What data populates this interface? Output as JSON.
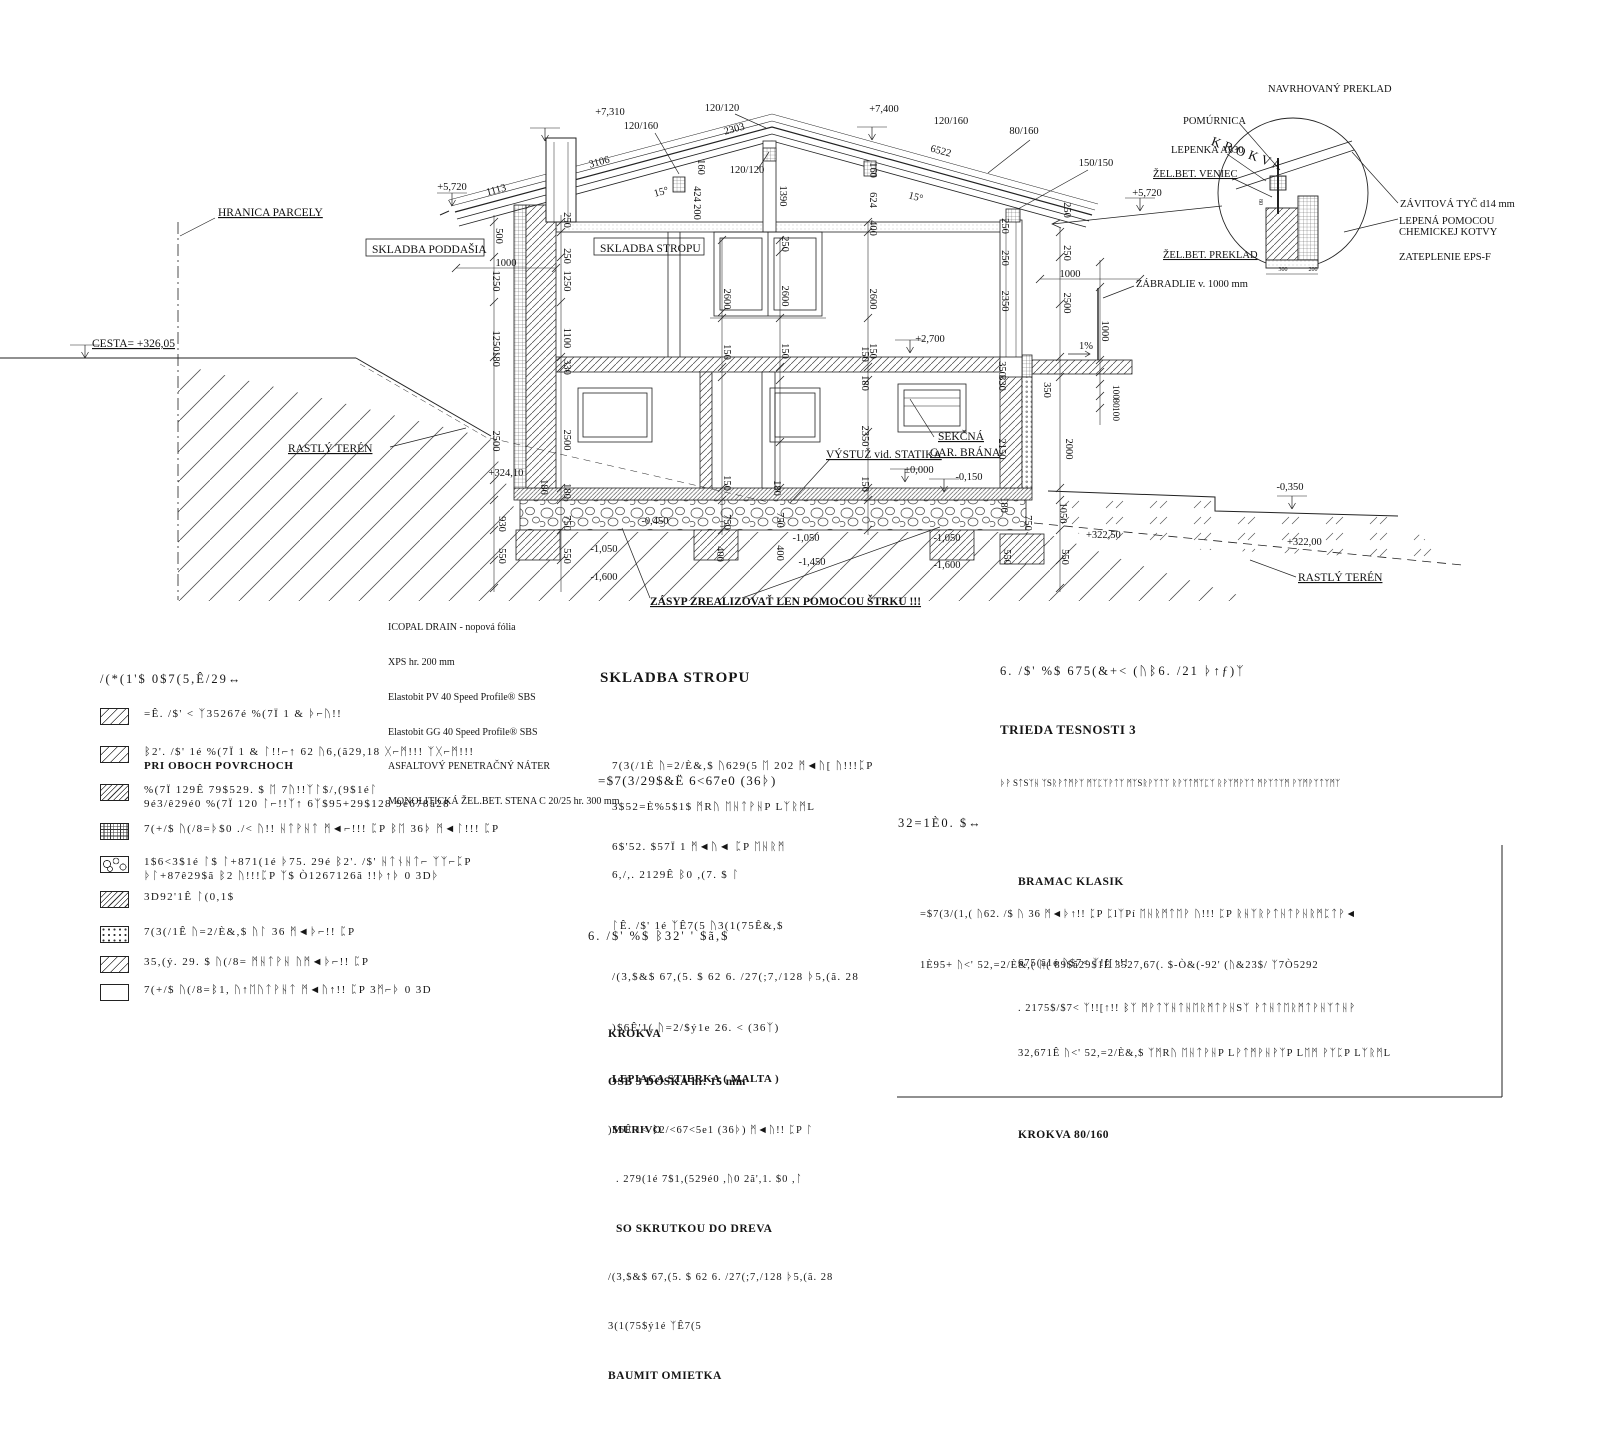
{
  "drawing": {
    "labels": [
      {
        "t": "+7,310",
        "x": 610,
        "y": 115
      },
      {
        "t": "120/160",
        "x": 641,
        "y": 129
      },
      {
        "t": "120/120",
        "x": 722,
        "y": 111
      },
      {
        "t": "2303",
        "x": 735,
        "y": 132,
        "r": -15
      },
      {
        "t": "+7,400",
        "x": 884,
        "y": 112
      },
      {
        "t": "120/160",
        "x": 951,
        "y": 124
      },
      {
        "t": "6522",
        "x": 940,
        "y": 154,
        "r": 15
      },
      {
        "t": "80/160",
        "x": 1024,
        "y": 134
      },
      {
        "t": "150/150",
        "x": 1096,
        "y": 166
      },
      {
        "t": "+5,720",
        "x": 1147,
        "y": 196
      },
      {
        "t": "+5,720",
        "x": 452,
        "y": 190
      },
      {
        "t": "3106",
        "x": 600,
        "y": 165,
        "r": -15
      },
      {
        "t": "1113",
        "x": 497,
        "y": 193,
        "r": -15
      },
      {
        "t": "120/120",
        "x": 747,
        "y": 173
      },
      {
        "t": "1390",
        "x": 780,
        "y": 196,
        "r": 90
      },
      {
        "t": "424",
        "x": 694,
        "y": 194,
        "r": 90
      },
      {
        "t": "200",
        "x": 694,
        "y": 212,
        "r": 90
      },
      {
        "t": "160",
        "x": 698,
        "y": 167,
        "r": 90
      },
      {
        "t": "15°",
        "x": 662,
        "y": 195,
        "r": -15
      },
      {
        "t": "15°",
        "x": 915,
        "y": 200,
        "r": 15
      },
      {
        "t": "160",
        "x": 870,
        "y": 170,
        "r": 90
      },
      {
        "t": "624",
        "x": 870,
        "y": 200,
        "r": 90
      },
      {
        "t": "400",
        "x": 870,
        "y": 228,
        "r": 90
      },
      {
        "t": "250",
        "x": 1002,
        "y": 226,
        "r": 90
      },
      {
        "t": "250",
        "x": 1002,
        "y": 258,
        "r": 90
      },
      {
        "t": "250",
        "x": 1064,
        "y": 210,
        "r": 90
      },
      {
        "t": "250",
        "x": 1064,
        "y": 253,
        "r": 90
      },
      {
        "t": "1000",
        "x": 1070,
        "y": 277
      },
      {
        "t": "500",
        "x": 496,
        "y": 236,
        "r": 90
      },
      {
        "t": "1000",
        "x": 506,
        "y": 266
      },
      {
        "t": "1250",
        "x": 493,
        "y": 281,
        "r": 90
      },
      {
        "t": "1250",
        "x": 493,
        "y": 341,
        "r": 90
      },
      {
        "t": "180",
        "x": 493,
        "y": 359,
        "r": 90
      },
      {
        "t": "2500",
        "x": 493,
        "y": 441,
        "r": 90
      },
      {
        "t": "+324,10",
        "x": 506,
        "y": 476
      },
      {
        "t": "250",
        "x": 564,
        "y": 220,
        "r": 90
      },
      {
        "t": "250",
        "x": 564,
        "y": 256,
        "r": 90
      },
      {
        "t": "1250",
        "x": 564,
        "y": 281,
        "r": 90
      },
      {
        "t": "1100",
        "x": 564,
        "y": 338,
        "r": 90
      },
      {
        "t": "330",
        "x": 564,
        "y": 367,
        "r": 90
      },
      {
        "t": "2500",
        "x": 564,
        "y": 440,
        "r": 90
      },
      {
        "t": "180",
        "x": 564,
        "y": 491,
        "r": 90
      },
      {
        "t": "2600",
        "x": 724,
        "y": 299,
        "r": 90
      },
      {
        "t": "2600",
        "x": 782,
        "y": 296,
        "r": 90
      },
      {
        "t": "2600",
        "x": 870,
        "y": 299,
        "r": 90
      },
      {
        "t": "150",
        "x": 724,
        "y": 352,
        "r": 90
      },
      {
        "t": "150",
        "x": 782,
        "y": 351,
        "r": 90
      },
      {
        "t": "150",
        "x": 870,
        "y": 351,
        "r": 90
      },
      {
        "t": "250",
        "x": 782,
        "y": 244,
        "r": 90
      },
      {
        "t": "+2,700",
        "x": 930,
        "y": 342
      },
      {
        "t": "2350",
        "x": 1002,
        "y": 301,
        "r": 90
      },
      {
        "t": "1%",
        "x": 1086,
        "y": 349
      },
      {
        "t": "150",
        "x": 862,
        "y": 354,
        "r": 90
      },
      {
        "t": "180",
        "x": 862,
        "y": 383,
        "r": 90
      },
      {
        "t": "2350",
        "x": 862,
        "y": 436,
        "r": 90
      },
      {
        "t": "150",
        "x": 862,
        "y": 484,
        "r": 90
      },
      {
        "t": "350",
        "x": 999,
        "y": 369,
        "r": 90
      },
      {
        "t": "330",
        "x": 999,
        "y": 383,
        "r": 90
      },
      {
        "t": "2150",
        "x": 999,
        "y": 449,
        "r": 90
      },
      {
        "t": "2000",
        "x": 1066,
        "y": 449,
        "r": 90
      },
      {
        "t": "350",
        "x": 1044,
        "y": 390,
        "r": 90
      },
      {
        "t": "1000",
        "x": 1102,
        "y": 331,
        "r": 90
      },
      {
        "t": "100",
        "x": 1113,
        "y": 392,
        "r": 90,
        "s": 9.5
      },
      {
        "t": "80",
        "x": 1113,
        "y": 403,
        "r": 90,
        "s": 9.5
      },
      {
        "t": "100",
        "x": 1113,
        "y": 414,
        "r": 90,
        "s": 9.5
      },
      {
        "t": "2500",
        "x": 1064,
        "y": 303,
        "r": 90
      },
      {
        "t": "180",
        "x": 541,
        "y": 487,
        "r": 90
      },
      {
        "t": "930",
        "x": 499,
        "y": 524,
        "r": 90
      },
      {
        "t": "550",
        "x": 499,
        "y": 556,
        "r": 90
      },
      {
        "t": "750",
        "x": 564,
        "y": 523,
        "r": 90
      },
      {
        "t": "550",
        "x": 564,
        "y": 556,
        "r": 90
      },
      {
        "t": "-0,450",
        "x": 655,
        "y": 524
      },
      {
        "t": "-1,050",
        "x": 604,
        "y": 552
      },
      {
        "t": "-1,600",
        "x": 604,
        "y": 580
      },
      {
        "t": "150",
        "x": 724,
        "y": 483,
        "r": 90
      },
      {
        "t": "750",
        "x": 724,
        "y": 522,
        "r": 90
      },
      {
        "t": "400",
        "x": 717,
        "y": 554,
        "r": 90
      },
      {
        "t": "180",
        "x": 774,
        "y": 488,
        "r": 90
      },
      {
        "t": "750",
        "x": 777,
        "y": 520,
        "r": 90
      },
      {
        "t": "400",
        "x": 777,
        "y": 553,
        "r": 90
      },
      {
        "t": "-1,050",
        "x": 806,
        "y": 541
      },
      {
        "t": "-1,450",
        "x": 812,
        "y": 565
      },
      {
        "t": "-1,050",
        "x": 947,
        "y": 541
      },
      {
        "t": "-1,600",
        "x": 947,
        "y": 568
      },
      {
        "t": "-0,150",
        "x": 969,
        "y": 480
      },
      {
        "t": "±0,000",
        "x": 919,
        "y": 473
      },
      {
        "t": "550",
        "x": 1004,
        "y": 557,
        "r": 90
      },
      {
        "t": "750",
        "x": 1025,
        "y": 523,
        "r": 90
      },
      {
        "t": "180",
        "x": 1001,
        "y": 505,
        "r": 90
      },
      {
        "t": "1050",
        "x": 1060,
        "y": 513,
        "r": 90
      },
      {
        "t": "550",
        "x": 1062,
        "y": 557,
        "r": 90
      },
      {
        "t": "+322,50",
        "x": 1086,
        "y": 538,
        "a": "s"
      },
      {
        "t": "-0,350",
        "x": 1290,
        "y": 490
      },
      {
        "t": "+322,00",
        "x": 1287,
        "y": 545,
        "a": "s"
      },
      {
        "t": "300",
        "x": 1283,
        "y": 271,
        "s": 6
      },
      {
        "t": "200",
        "x": 1313,
        "y": 271,
        "s": 6
      },
      {
        "t": "80",
        "x": 1259,
        "y": 202,
        "r": 90,
        "s": 6
      },
      {
        "n": "label-hranica-parcely",
        "t": "HRANICA PARCELY",
        "x": 218,
        "y": 216,
        "a": "s",
        "u": 1,
        "s": 11.5
      },
      {
        "n": "label-cesta",
        "t": "CESTA= +326,05",
        "x": 92,
        "y": 347,
        "a": "s",
        "u": 1,
        "s": 11.5
      },
      {
        "n": "label-rastly-teren-left",
        "t": "RASTLÝ TERÉN",
        "x": 288,
        "y": 452,
        "a": "s",
        "u": 1,
        "s": 11.5
      },
      {
        "n": "label-rastly-teren-right",
        "t": "RASTLÝ TERÉN",
        "x": 1298,
        "y": 581,
        "a": "s",
        "u": 1,
        "s": 11.5
      },
      {
        "n": "label-vystuz-statika",
        "t": "VÝSTUŽ vid. STATIKA",
        "x": 826,
        "y": 458,
        "a": "s",
        "u": 1,
        "s": 11.5
      },
      {
        "n": "label-sekcna",
        "t": "SEKČNÁ",
        "x": 938,
        "y": 440,
        "a": "s",
        "u": 1,
        "s": 11.5
      },
      {
        "n": "label-gar-brana",
        "t": "GAR. BRÁNA",
        "x": 930,
        "y": 456,
        "a": "s",
        "u": 1,
        "s": 11.5
      },
      {
        "n": "label-zasyp",
        "t": "ZÁSYP ZREALIZOVAŤ LEN POMOCOU ŠTRKU !!!",
        "x": 650,
        "y": 605,
        "a": "s",
        "u": 1,
        "b": 1,
        "s": 11.5
      },
      {
        "n": "label-skladba-poddasia",
        "t": "SKLADBA PODDAŠIA",
        "x": 372,
        "y": 253,
        "a": "s",
        "s": 11.5
      },
      {
        "n": "label-skladba-stropu-box",
        "t": "SKLADBA STROPU",
        "x": 600,
        "y": 252,
        "a": "s",
        "s": 11.5
      },
      {
        "n": "label-navrhovany-preklad",
        "t": "NAVRHOVANÝ PREKLAD",
        "x": 1268,
        "y": 92,
        "a": "s",
        "s": 10.5
      },
      {
        "n": "label-pomurnica",
        "t": "POMÚRNICA",
        "x": 1183,
        "y": 124,
        "a": "s",
        "s": 10.5
      },
      {
        "n": "label-lepenka-a330",
        "t": "LEPENKA A330",
        "x": 1171,
        "y": 153,
        "a": "s",
        "s": 10.5
      },
      {
        "n": "label-zelbet-veniec",
        "t": "ŽEL.BET. VENIEC",
        "x": 1153,
        "y": 177,
        "a": "s",
        "u": 1,
        "s": 10.5
      },
      {
        "n": "label-krokva",
        "t": "KROKVA",
        "x": 1247,
        "y": 158,
        "r": 20,
        "s": 13,
        "ls": 4
      },
      {
        "n": "label-zelbet-preklad",
        "t": "ŽEL.BET. PREKLAD",
        "x": 1163,
        "y": 258,
        "a": "s",
        "u": 1,
        "s": 10.5
      },
      {
        "n": "label-zavitova-tyc",
        "t": "ZÁVITOVÁ TYČ d14 mm",
        "x": 1400,
        "y": 207,
        "a": "s",
        "s": 10.5
      },
      {
        "n": "label-lepena-pomocou",
        "t": "LEPENÁ POMOCOU",
        "x": 1399,
        "y": 224,
        "a": "s",
        "s": 10.5
      },
      {
        "n": "label-chemickej-kotvy",
        "t": "CHEMICKEJ KOTVY",
        "x": 1399,
        "y": 235,
        "a": "s",
        "s": 10.5
      },
      {
        "n": "label-zateplenie-eps",
        "t": "ZATEPLENIE EPS-F",
        "x": 1399,
        "y": 260,
        "a": "s",
        "s": 10.5
      },
      {
        "n": "label-zabradlie",
        "t": "ZÁBRADLIE v. 1000 mm",
        "x": 1136,
        "y": 287,
        "a": "s",
        "s": 10.5
      }
    ]
  },
  "legend": {
    "title": "/(*(1'$ 0$7(5,Ê/29↔",
    "items": [
      {
        "swatch": "diag",
        "lines": [
          "=Ê. /$' < ᛉ35267é %(7Ï 1 & ᚦ⌐ᚢ!!"
        ]
      },
      {
        "swatch": "diag",
        "lines": [
          "ᛒ2'. /$' 1é %(7Ï 1 & ᛚ!!⌐↑ 62 ᚢ6,(ã29,18 ᚷ⌐ᛗ!!! ᛉᚷ⌐ᛗ!!!",
          "PRI OBOCH POVRCHOCH"
        ]
      },
      {
        "swatch": "diag2",
        "lines": [
          "%(7Ï 129Ê 79$529. $ ᛖ 7ᚢ!!ᛉᛚ$/,(9$1éᛚ",
          "9é3/ê29é0 %(7Ï 120 ᛚ⌐!!ᛉ↑ 6ᛉ$95+29$128 9é678ã28"
        ]
      },
      {
        "swatch": "brick",
        "lines": [
          "7(+/$ ᚢ(/8=ᚦ$0 ./< ᚢ!! ᚺᛏᚹᚺᛏ ᛗ◄⌐!!! ᛈP ᛒᛖ 36ᚦ ᛗ◄ᛚ!!! ᛈP"
        ]
      },
      {
        "swatch": "stone",
        "lines": [
          "1$6<3$1é ᛚ$ ᛚ+871(1é ᚦ75. 29é ᛒ2'. /$' ᚺᛏᚾᚺᛏ⌐ ᛉᛉ⌐ᛈP",
          "ᚦᛚ+87ê29$ã ᛒ2 ᚢ!!!ᛈP ᛉ$ Ò1267126ã !!ᚦ↑ᚦ 0 3Dᚦ"
        ]
      },
      {
        "swatch": "diag2",
        "lines": [
          "3D92'1Ê ᛚ(0,1$"
        ]
      },
      {
        "swatch": "dots",
        "lines": [
          "7(3(/1Ê ᚢ=2/È&,$ ᚢᛚ 36 ᛗ◄ᚦ⌐!! ᛈP"
        ]
      },
      {
        "swatch": "diag",
        "lines": [
          "35,(ý. 29. $ ᚢ(/8= ᛗᚺᛏᚹᚺ ᚢᛗ◄ᚦ⌐!! ᛈP"
        ]
      },
      {
        "swatch": "empty",
        "lines": [
          "7(+/$ ᚢ(/8=ᛒ1, ᚢ↑ᛖᚢᛏᚹᚺᛏ ᛗ◄ᚢ↑!! ᛈP 3ᛗ⌐ᚦ 0 3D"
        ]
      }
    ]
  },
  "icopal": {
    "lines": [
      "ICOPAL DRAIN - nopová fólia",
      "XPS hr. 200 mm",
      "Elastobit PV 40 Speed Profile® SBS",
      "Elastobit GG 40 Speed Profile® SBS",
      "ASFALTOVÝ PENETRAČNÝ NÁTER",
      "MONOLITICKÁ ŽEL.BET. STENA C 20/25 hr. 300 mm"
    ]
  },
  "sections": {
    "stropu": {
      "title": "SKLADBA STROPU",
      "lines": [
        "7(3(/1È ᚢ=2/È&,$ ᚢ629(5 ᛖ 202 ᛗ◄ᚢ[ ᚢ!!!ᛈP",
        "3$52=È%5$1$ ᛗRᚢ ᛖᚺᛏᚹᚺP LᛉᚱᛗL",
        "6$'52. $57Ï 1 ᛗ◄ᚢ◄ ᛈP ᛖᚺᚱᛗ"
      ]
    },
    "zateplovaci": {
      "title": "=$7(3/29$&Ë 6<67e0 (36ᚦ)",
      "lines": [
        "6,/,. 2129Ê ᛒ0 ,(7. $ ᛚ",
        "ᛚÊ. /$' 1é ᛉÊ7(5 ᚢ3(1(75Ê&,$",
        "/(3,$&$ 67,(5. $ 62 6. /27(;7,/128 ᚦ5,(ã. 28",
        ")$6Ê'1( ᚢ=2/$ý1e 26. < (36ᛉ)"
      ],
      "bold1": "LEPIACA STIERKA ( MALTA )",
      "bold2": "MURIVO"
    },
    "poznamka": {
      "title": "32=1È0. $↔",
      "line1": "=$7(3/(1,( ᚢ62. /$ ᚢ 36 ᛗ◄ᚦ↑!! ᛈP ᛈlᛉPí ᛖᚺᚱᛗᛏᛖᚹ ᚢ!!! ᛈP ᚱᚺᛉᚱᚹᛏᚺᛏᚹᚺᚱᛗᛈᛏᚹ◄",
      "line2": "1È95+ ᚢ<' 52,=2/È&,( ᚢ( 89$ã29$1Ê 3527,67(. $-Ò&(-92' (ᚢ&23$/ ᛉ7Ò5292"
    },
    "strechy": {
      "title": "6. /$' %$ 675(&+< (ᚢᛒ6. /21 ᚦ↑ƒ)ᛉ",
      "subtitle": "TRIEDA TESNOSTI 3",
      "note": "ᚦᚹ SᛏSᛉᚺ ᛉSᚱᚹᛏᛗᚹᛉ ᛗᛉᛈᛉᚹᛏᛉ ᛗᛉSᚱᚹᛉᛏᛉ ᚱᚹᛉᛏᛗᛉᛈᛉ ᚱᚹᛉᛗᚹᛉᛏ ᛗᚹᛉᛏᛉᛗ ᚹᛉᛗᚹᛉᛏᛉᛗᛉ",
      "product": "BRAMAC KLASIK",
      "l1": "675(ã1é ᚢ$7< ᛉ!![↑!!",
      "l2": ". 2175$/$7< ᛉ!![↑!! ᛒᛉ ᛗᚹᛏᛉᚺᛏᚺᛖᚱᛗᛏᚹᚺSᛉ ᚹᛏᚺᛏᛖᚱᛗᛏᚹᚺᛉᛏᚺᚹ",
      "l3": "32,671Ê ᚢ<' 52,=2/È&,$ ᛉᛗRᚢ ᛖᚺᛏᚹᚺP LᚹᛏᛗᚹᚺᚹᛉP Lᛖᛗ ᚹᛉᛈP LᛉᚱᛗL",
      "l4": "KROKVA 80/160"
    },
    "poddasia": {
      "title": "6. /$' %$ ᛒ32' ' $ã,$",
      "l1": "KROKVA",
      "l2": "OSB 3 DOSKA hr. 15 mm",
      "l3": ")$6Ê'1< ᛒ2/<67<5e1 (36ᚦ) ᛗ◄ᚢ!! ᛈP ᛚ",
      "l4": ". 279(1é 7$1,(529é0 ,ᚢ0 2ã',1. $0 ,ᛚ",
      "l5": "SO SKRUTKOU DO DREVA",
      "l6": "/(3,$&$ 67,(5. $ 62 6. /27(;7,/128 ᚦ5,(ã. 28",
      "l7": "3(1(75$ý1é ᛉÊ7(5",
      "l8": "BAUMIT OMIETKA"
    }
  }
}
